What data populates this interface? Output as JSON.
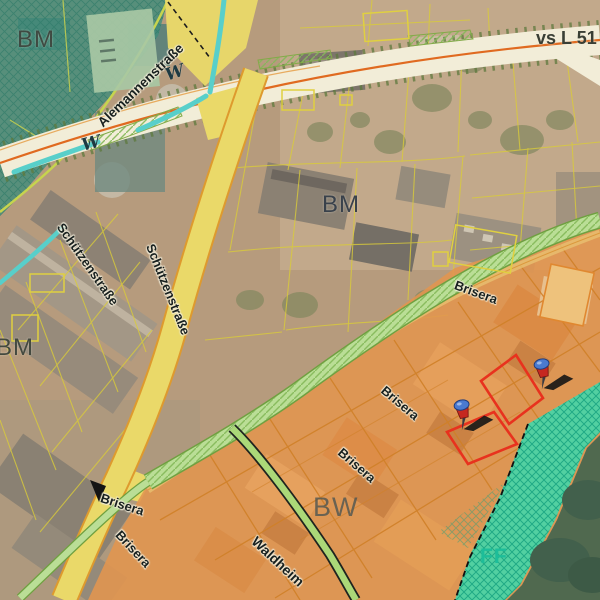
{
  "map": {
    "zone_labels": {
      "bm_topleft": "BM",
      "bm_center": "BM",
      "bm_left": "BM",
      "bw": "BW",
      "ff": "FF"
    },
    "road_labels": {
      "route": "vs L 51",
      "alemannenstrasse": "Alemannenstraße",
      "schuetzenstrasse_1": "Schützenstraße",
      "schuetzenstrasse_2": "Schützenstraße",
      "brisera_1": "Brisera",
      "brisera_2": "Brisera",
      "brisera_3": "Brisera",
      "brisera_4": "Brisera",
      "brisera_5": "Brisera",
      "waldheim": "Waldheim"
    },
    "symbols": {
      "water_1": "W",
      "water_2": "W"
    },
    "markers": [
      {
        "type": "pushpin",
        "x": 542,
        "y": 366
      },
      {
        "type": "pushpin",
        "x": 462,
        "y": 407
      }
    ],
    "selection": {
      "outline_color": "#e8321e",
      "parcel_count": 2
    },
    "colors": {
      "bm_zone_teal": "#4f9a88",
      "bw_zone_orange": "#e2954e",
      "ff_zone_teal": "#3fd8ac",
      "road_major": "#f2edd8",
      "road_minor": "#ead969",
      "road_centerline": "#e06a20",
      "green_strip": "#b9dc94",
      "stream": "#58cfca",
      "forest": "#50694f",
      "parcel_line": "#d9cb3a"
    }
  }
}
